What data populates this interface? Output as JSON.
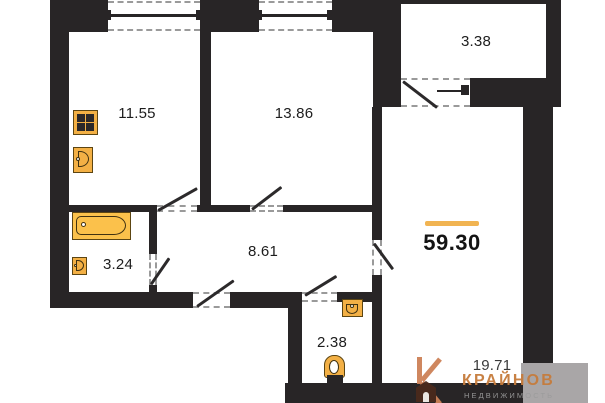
{
  "plan": {
    "type": "apartment-floor-plan",
    "total_area": "59.30",
    "rooms": {
      "kitchen": {
        "area": "11.55"
      },
      "bedroom": {
        "area": "13.86"
      },
      "balcony": {
        "area": "3.38"
      },
      "hallway": {
        "area": "8.61"
      },
      "bathroom": {
        "area": "3.24"
      },
      "wc": {
        "area": "2.38"
      },
      "living_room": {
        "area": "19.71"
      }
    },
    "fixtures": [
      "stove-icon",
      "kitchen-sink-icon",
      "bathtub-icon",
      "bathroom-sink-icon",
      "wc-sink-icon",
      "toilet-icon"
    ],
    "colors": {
      "wall": "#282526",
      "fixture_fill": "#F3B045",
      "fixture_stroke": "#5c4512",
      "accent_line": "#F1B452",
      "outside_block_gray": "#A9A6A7",
      "logo_orange": "#C67B3B",
      "logo_brown": "#4A2A1C",
      "logo_gray": "#9b9b9b"
    }
  },
  "logo": {
    "brand": "КРАЙНОВ",
    "tagline": "НЕДВИЖИМОСТЬ"
  }
}
